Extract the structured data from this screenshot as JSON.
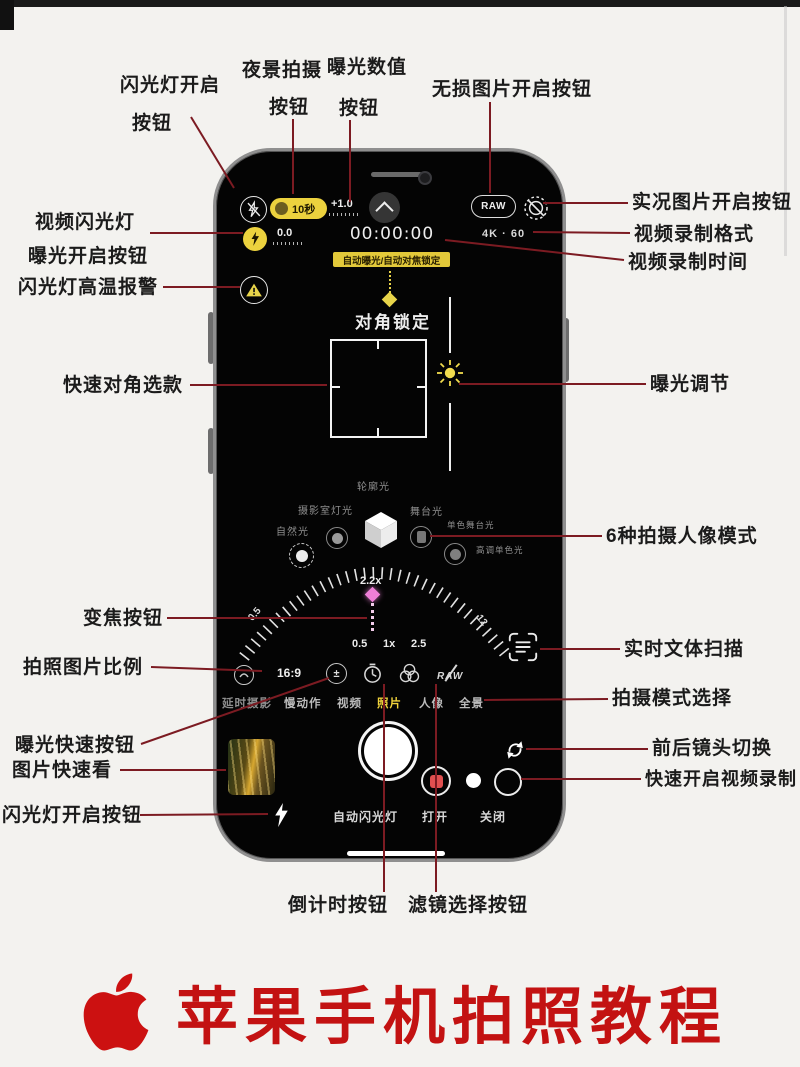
{
  "title": {
    "text": "苹果手机拍照教程"
  },
  "annotations": {
    "flash_on": {
      "line1": "闪光灯开启",
      "line2": "按钮"
    },
    "night": {
      "line1": "夜景拍摄",
      "line2": "按钮"
    },
    "exposure_value": {
      "line1": "曝光数值",
      "line2": "按钮"
    },
    "raw": "无损图片开启按钮",
    "live": "实况图片开启按钮",
    "video_format": "视频录制格式",
    "video_time": "视频录制时间",
    "exposure_adjust": "曝光调节",
    "portrait_modes": "6种拍摄人像模式",
    "live_text": "实时文体扫描",
    "mode_select": "拍摄模式选择",
    "flip": "前后镜头切换",
    "quick_record": "快速开启视频录制",
    "video_flash": "视频闪光灯",
    "exposure_on": "曝光开启按钮",
    "flash_temp": "闪光灯高温报警",
    "diag_select": "快速对角选款",
    "zoom": "变焦按钮",
    "aspect": "拍照图片比例",
    "exposure_quick": "曝光快速按钮",
    "quick_view": "图片快速看",
    "flash_bottom": "闪光灯开启按钮",
    "timer": "倒计时按钮",
    "filter": "滤镜选择按钮"
  },
  "camera": {
    "night_pill": "10秒",
    "ev": "+1.0",
    "raw_badge": "RAW",
    "exposure_indicator": "0.0",
    "rec_time": "00:00:00",
    "video_format": "4K · 60",
    "ae_badge": "自动曝光/自动对焦锁定",
    "lock_title": "对角锁定",
    "lighting": {
      "top": "轮廓光",
      "left": "摄影室灯光",
      "far_left": "自然光",
      "right": "舞台光",
      "right2": "单色舞台光",
      "right3": "高调单色光"
    },
    "zoom_current": "2.2x",
    "dial_min": "0.5",
    "dial_max": "12",
    "zoom_presets": [
      "0.5",
      "1x",
      "2.5"
    ],
    "aspect_ratio": "16:9",
    "raw_off": "RAW",
    "modes": [
      {
        "label": "延时摄影"
      },
      {
        "label": "慢动作"
      },
      {
        "label": "视频"
      },
      {
        "label": "照片",
        "active": true
      },
      {
        "label": "人像"
      },
      {
        "label": "全景"
      }
    ],
    "flash_options": [
      "自动闪光灯",
      "打开",
      "关闭"
    ]
  },
  "colors": {
    "accent_yellow": "#ecd23e",
    "annotation_line": "#7c1b22",
    "title_red": "#c31212",
    "zoom_marker": "#ef7fd7"
  }
}
